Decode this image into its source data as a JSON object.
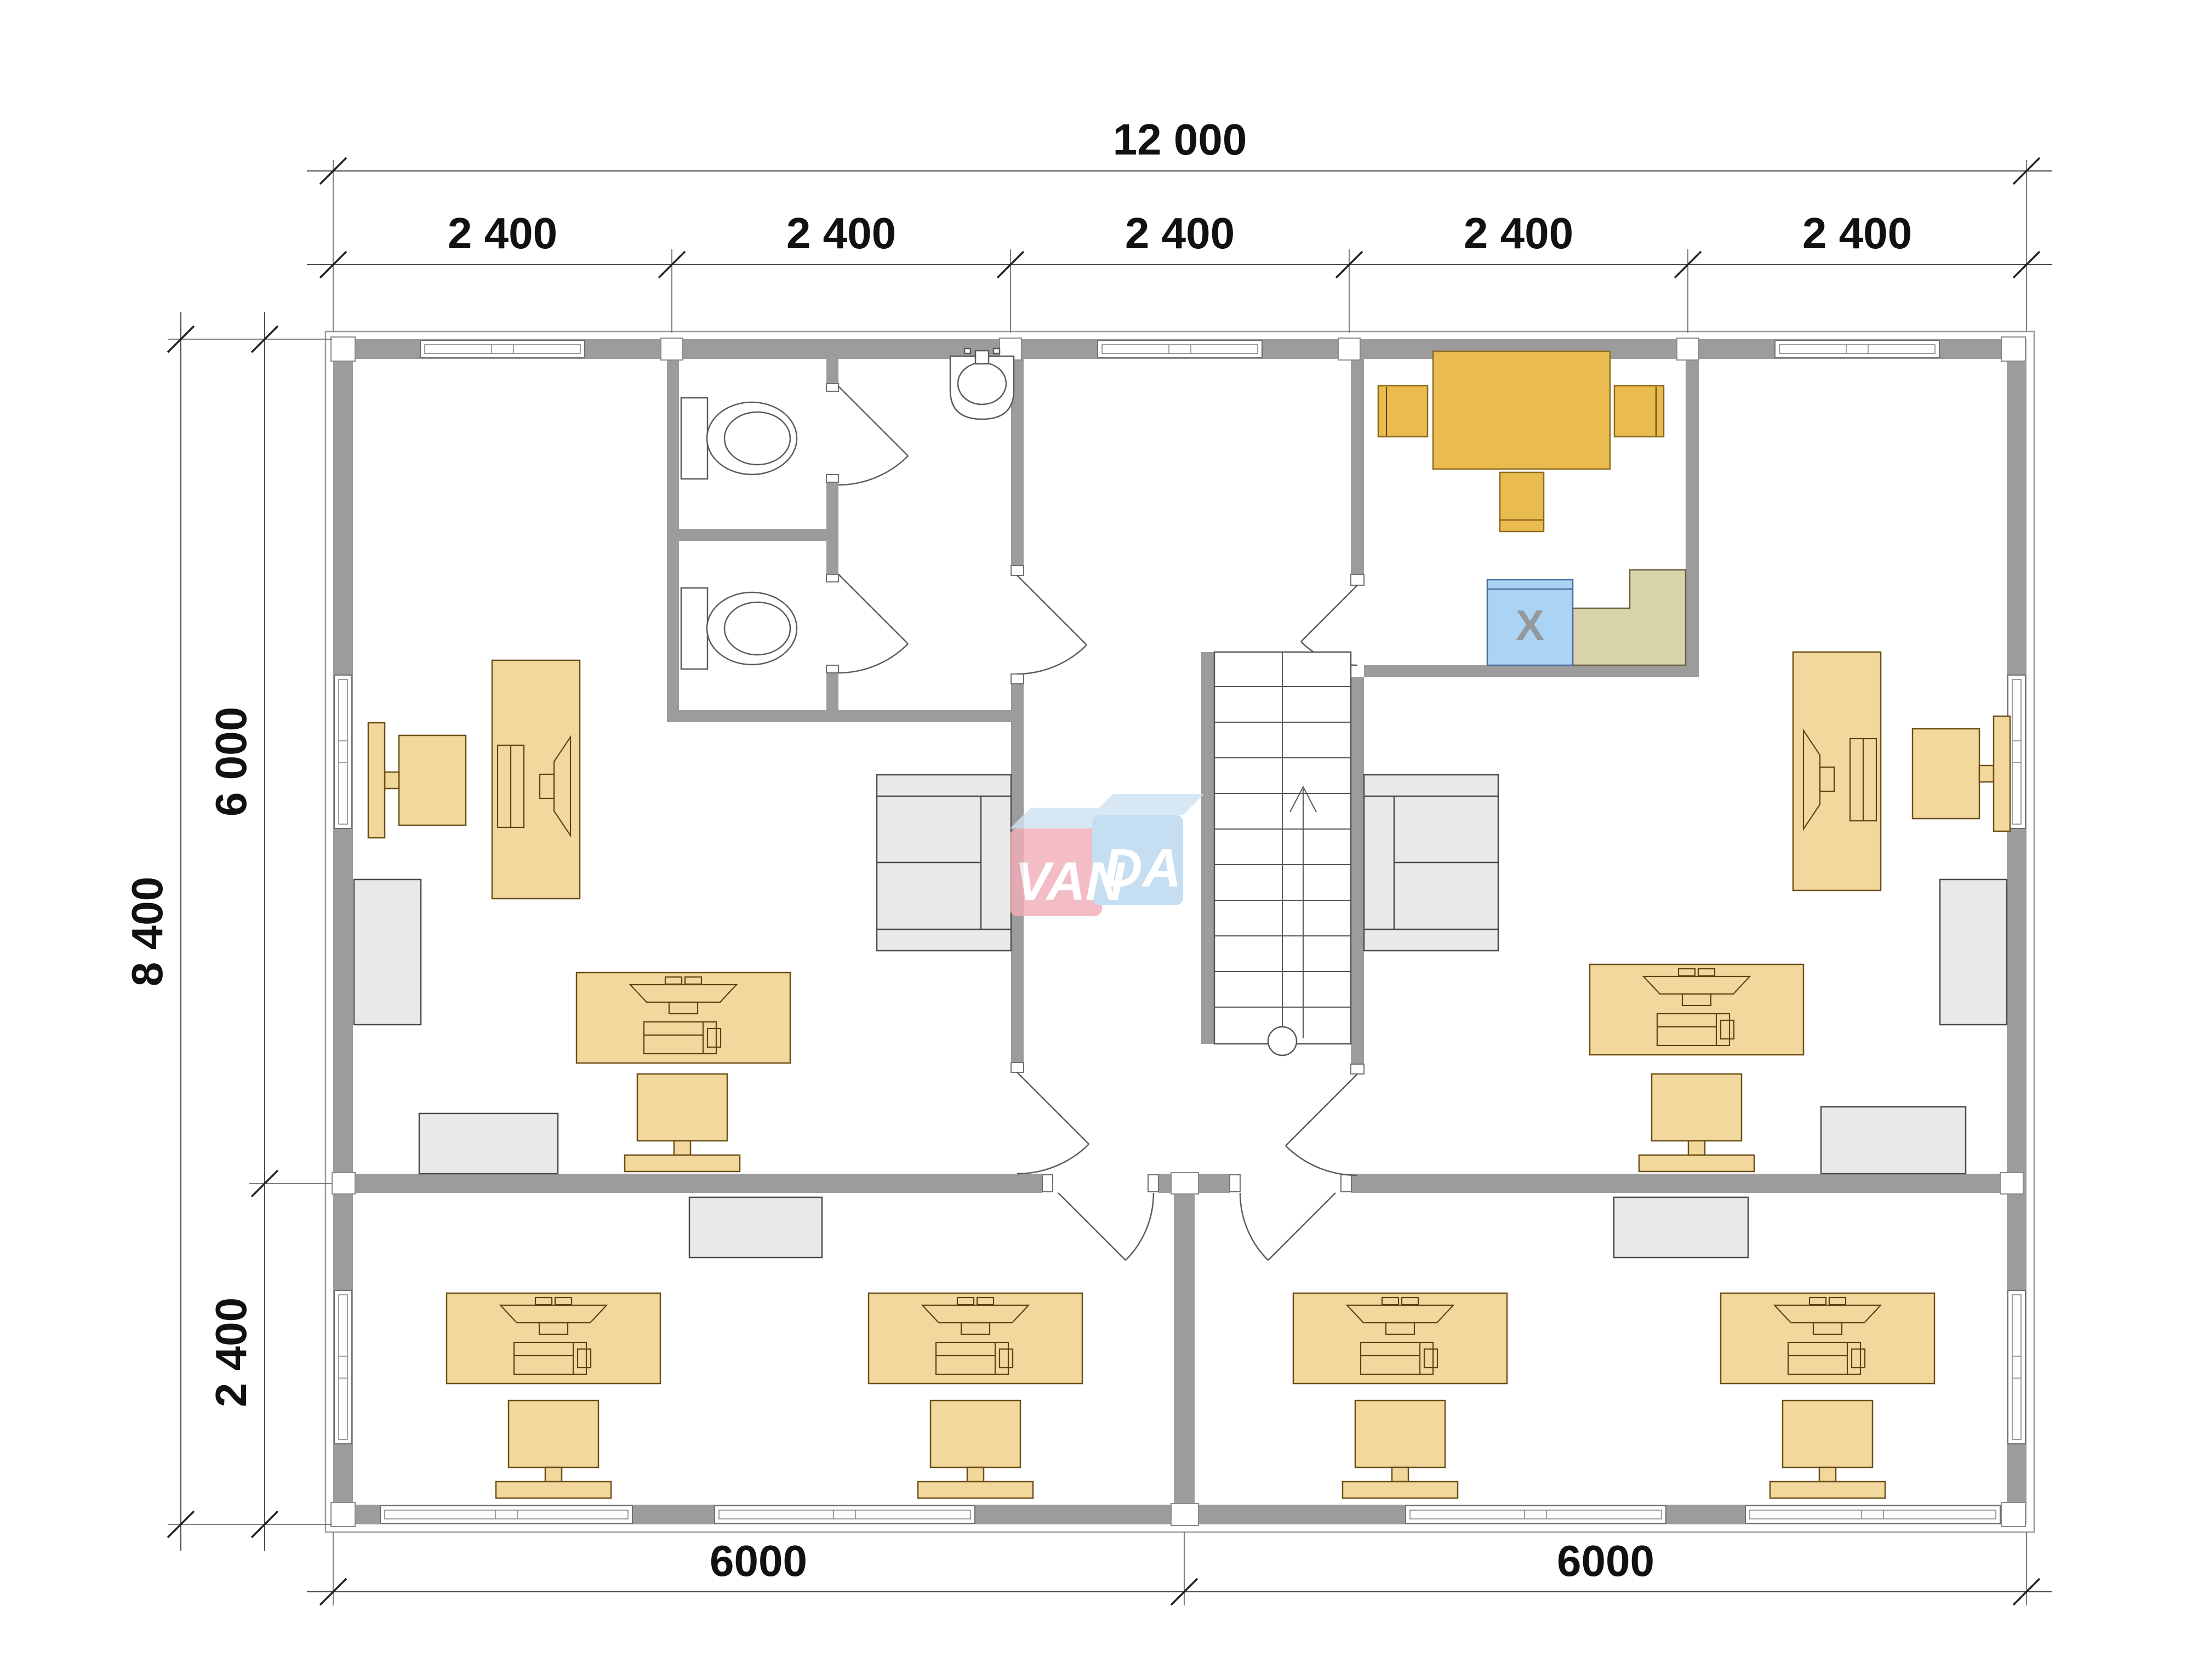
{
  "drawing": {
    "type": "office-floor-plan",
    "brand": "VANDA"
  },
  "colors": {
    "wall": "#9c9c9c",
    "desk": "#f3d89e",
    "table": "#eabb4e",
    "appliance": "#abd3f4",
    "counter": "#d9d3a9",
    "cabinet": "#e9e9e9",
    "wm_pink": "#f2aeb9",
    "wm_blue": "#b9d7ee",
    "wm_top": "#cfe3f2"
  },
  "dimensions": {
    "top": {
      "total": "12 000",
      "bays": [
        "2 400",
        "2 400",
        "2 400",
        "2 400",
        "2 400"
      ]
    },
    "left": {
      "total": "8 400",
      "upper": "6 000",
      "lower": "2 400"
    },
    "bottom": {
      "left": "6000",
      "right": "6000"
    }
  },
  "watermark": {
    "left": "VAN",
    "right": "DA"
  },
  "kitchen": {
    "appliance_label": "X"
  }
}
